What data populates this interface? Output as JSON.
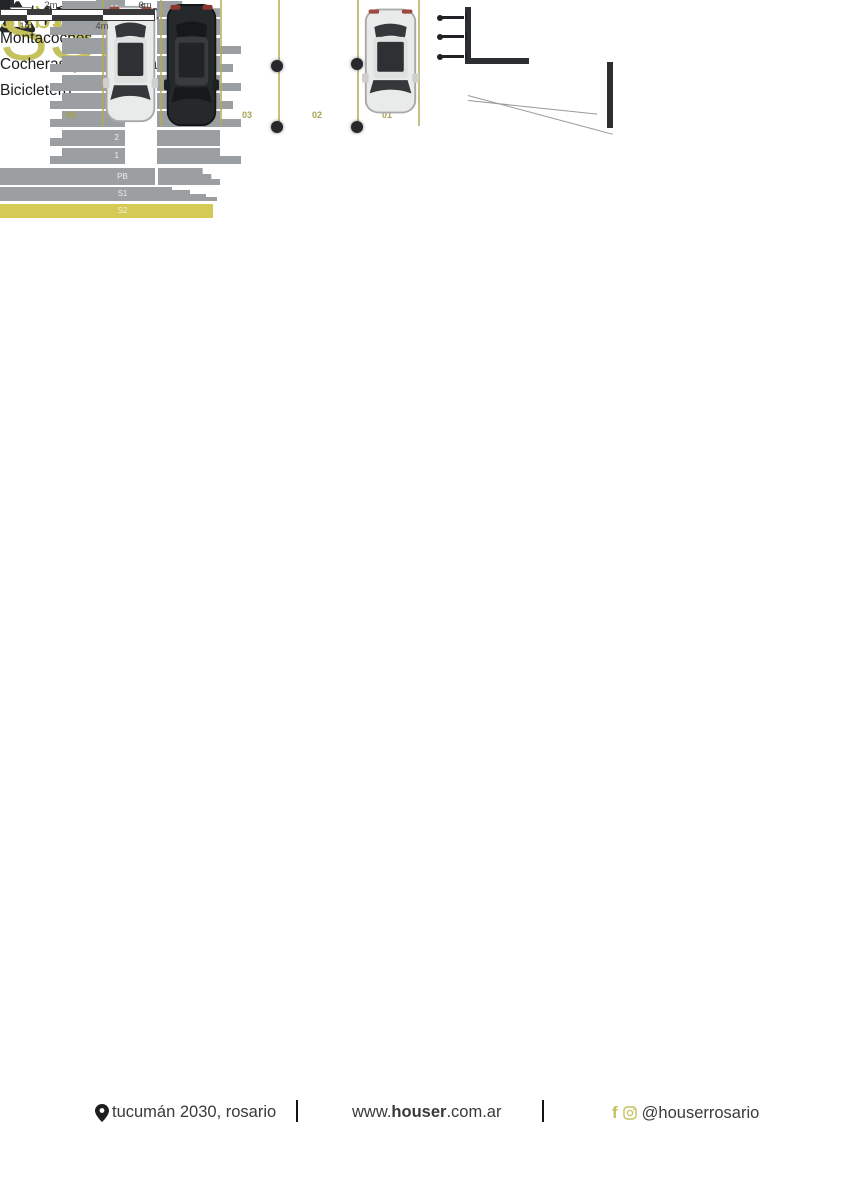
{
  "accent_color": "#c5c15e",
  "highlight_color": "#d4ca55",
  "header": {
    "brand_bold": "houser",
    "brand_light": "tucumán",
    "corner_logo_text": "Houser"
  },
  "title": {
    "code": "SS2",
    "name": "subsuelo 2"
  },
  "features": [
    "Nivel -3,60m",
    "Montacoches",
    "Cocheras (01 al 06+baulera)",
    "Bicicletero"
  ],
  "stack_diagram": {
    "floors": [
      "A2",
      "8",
      "7",
      "6",
      "5",
      "4",
      "3",
      "2",
      "1"
    ],
    "base_levels": [
      "PB",
      "S1",
      "S2"
    ],
    "highlighted_level": "S2",
    "block_color": "#9b9fa1",
    "highlight_color": "#d4ca55"
  },
  "plan": {
    "spots": [
      "06",
      "04",
      "03",
      "02",
      "01"
    ],
    "line_color": "#b0ab55"
  },
  "scale_bar": {
    "labels_above": [
      "2m",
      "6m"
    ],
    "labels_below": [
      "1m",
      "4m"
    ]
  },
  "footer": {
    "address": "tucumán 2030, rosario",
    "url_prefix": "www.",
    "url_bold": "houser",
    "url_suffix": ".com.ar",
    "social_handle": "@houserrosario"
  }
}
